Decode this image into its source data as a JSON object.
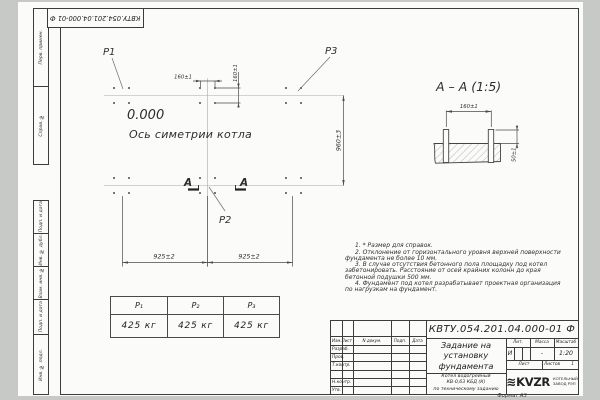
{
  "corner_stamp": "КВТУ.054.201.04.000-01 Ф",
  "margin": {
    "labels": [
      "Перв. примен.",
      "Справ. №",
      "Подп. и дата",
      "Инв. № дубл.",
      "Взам. инв. №",
      "Подп. и дата",
      "Инв. № подл."
    ]
  },
  "plan": {
    "p1": "P1",
    "p2": "P2",
    "p3": "P3",
    "level_mark": "0.000",
    "axis_label": "Ось симетрии котла",
    "section_letter": "А",
    "dim_160_h": "160±1",
    "dim_160_v": "160±1",
    "dim_960": "960±3",
    "dim_925_left": "925±2",
    "dim_925_right": "925±2"
  },
  "section": {
    "title": "А – А (1:5)",
    "dim_160": "160±1",
    "dim_50": "50±1"
  },
  "loads_table": {
    "headers": [
      "P₁",
      "P₂",
      "P₃"
    ],
    "values": [
      "425 кг",
      "425 кг",
      "425 кг"
    ]
  },
  "notes": [
    "1. * Размер для справок.",
    "2. Отклонение от горизонтального уровня верхней поверхности фундамента не более 10 мм.",
    "3. В случае отсутствия бетонного пола площадку под котел забетонировать. Расстояние от осей крайних колонн до края бетонной подушки 500 мм.",
    "4. Фундамент под котел разрабатывает проектная организация по нагрузкам на фундамент."
  ],
  "title_block": {
    "designation": "КВТУ.054.201.04.000-01 Ф",
    "change_header": "Изм.Лист",
    "doc_col": "N докум.",
    "sign_col": "Подп.",
    "date_col": "Дата",
    "rows": [
      "Разраб.",
      "Пров.",
      "Т.контр.",
      "",
      "Н.контр.",
      "Утв."
    ],
    "doc_title": [
      "Задание на",
      "установку",
      "фундамента"
    ],
    "product": [
      "Котел водогрейный",
      "КВ-0,63 КБД (К)",
      "по техническому заданию"
    ],
    "lit_label": "Лит.",
    "mass_label": "Масса",
    "scale_label": "Масштаб",
    "lit_value": "И",
    "mass_value": "-",
    "scale_value": "1:20",
    "sheet_label": "Лист",
    "sheets_label": "Листов",
    "sheets_value": "1",
    "logo_wave": "≋",
    "logo_text": "KVZR",
    "company": [
      "КОТЕЛЬНЫЙ",
      "ЗАВОД РЭП"
    ],
    "format_note": "Формат А3"
  }
}
